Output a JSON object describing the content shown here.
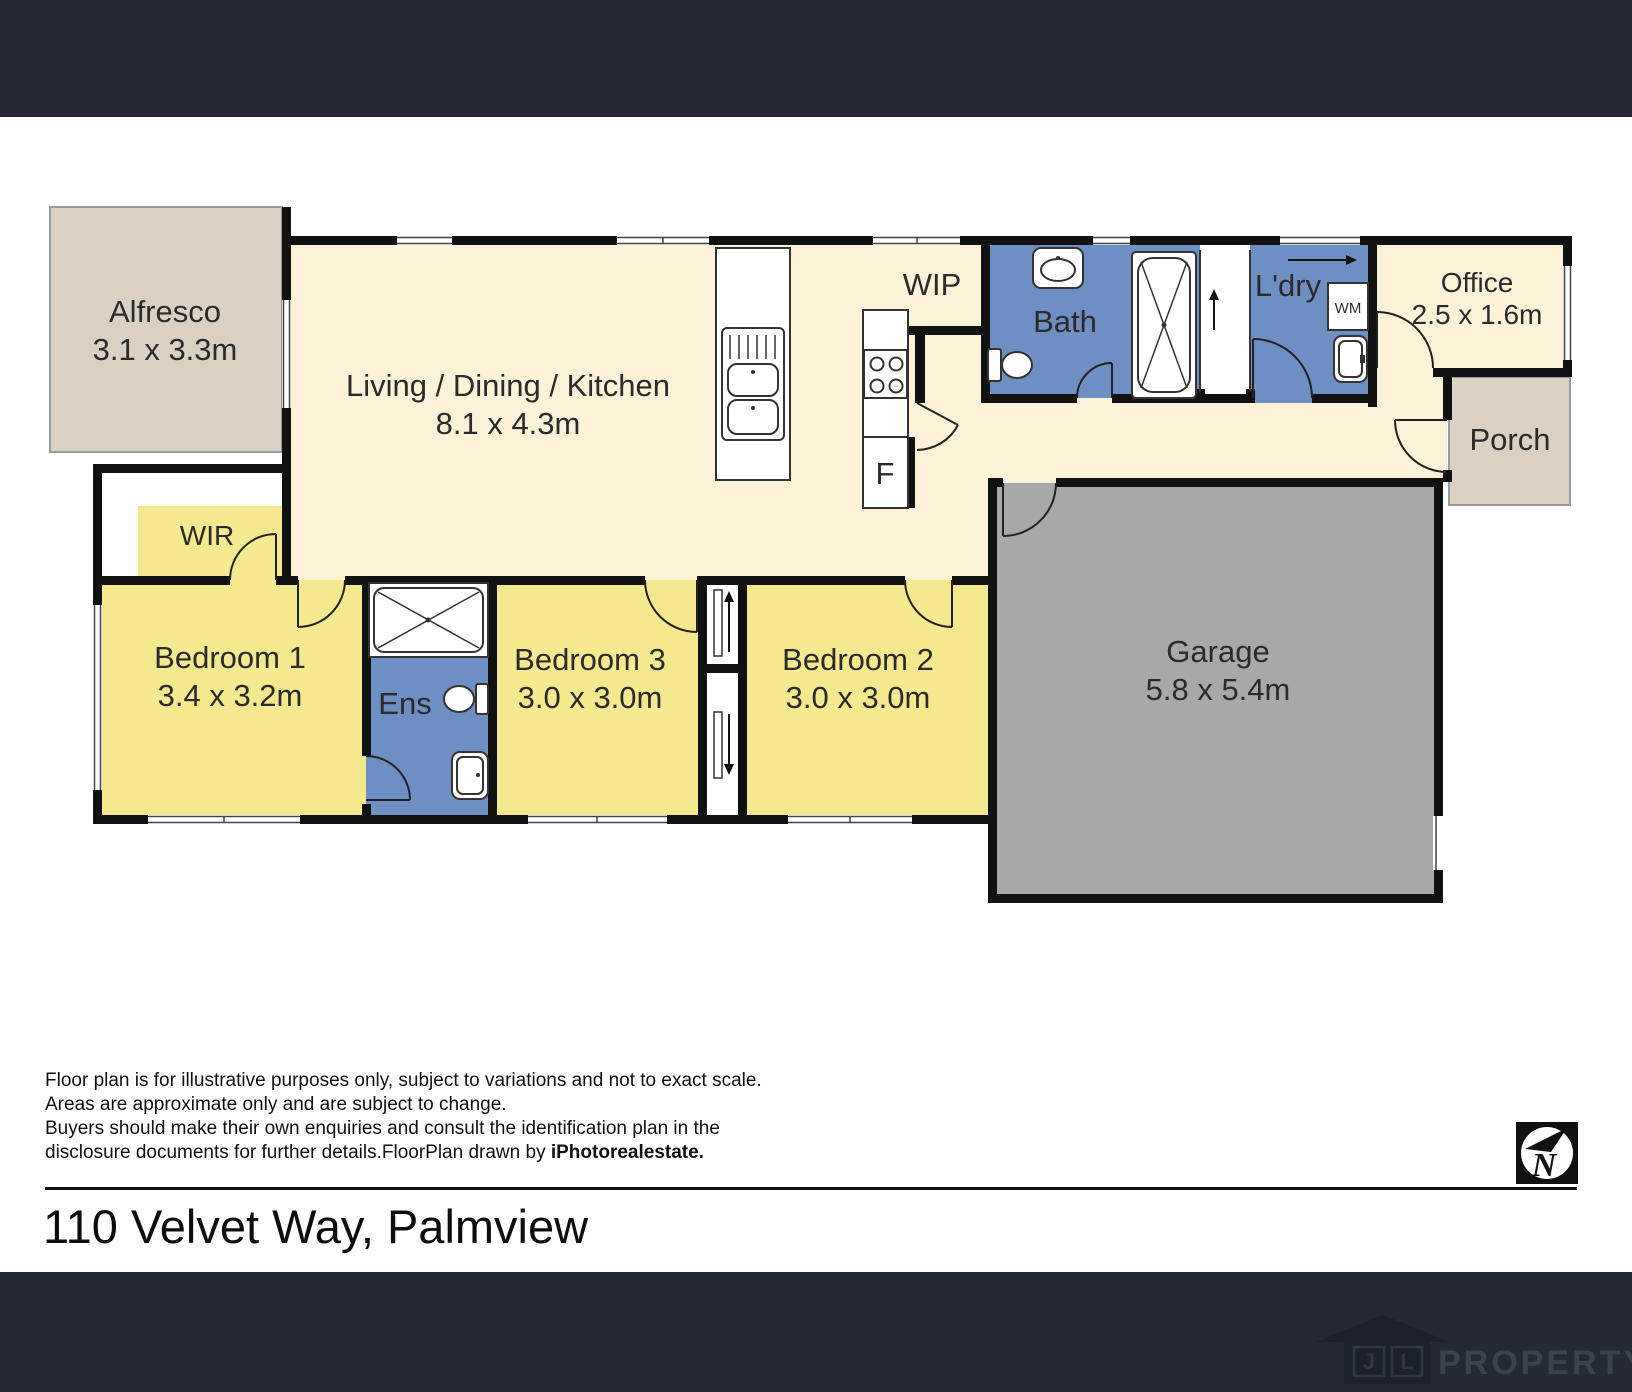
{
  "address": "110 Velvet Way, Palmview",
  "disclaimer": {
    "line1": "Floor plan is for illustrative purposes only, subject to variations and not to exact scale.",
    "line2": "Areas are approximate only and are subject to change.",
    "line3": "Buyers should make their own enquiries and consult the identification plan in the",
    "line4_prefix": "disclosure documents for further details.FloorPlan drawn by ",
    "line4_bold": "iPhotorealestate."
  },
  "compass": {
    "letter": "N"
  },
  "footer_brand": {
    "initial_j": "J",
    "initial_l": "L",
    "name": "PROPERTY"
  },
  "rooms": {
    "alfresco": {
      "name": "Alfresco",
      "dims": "3.1 x 3.3m"
    },
    "living": {
      "name": "Living / Dining / Kitchen",
      "dims": "8.1 x 4.3m"
    },
    "wip": {
      "name": "WIP"
    },
    "bath": {
      "name": "Bath"
    },
    "ldry": {
      "name": "L'dry"
    },
    "office": {
      "name": "Office",
      "dims": "2.5 x 1.6m"
    },
    "porch": {
      "name": "Porch"
    },
    "wir": {
      "name": "WIR"
    },
    "bed1": {
      "name": "Bedroom 1",
      "dims": "3.4 x 3.2m"
    },
    "ens": {
      "name": "Ens"
    },
    "bed3": {
      "name": "Bedroom 3",
      "dims": "3.0 x 3.0m"
    },
    "bed2": {
      "name": "Bedroom 2",
      "dims": "3.0 x 3.0m"
    },
    "garage": {
      "name": "Garage",
      "dims": "5.8 x 5.4m"
    }
  },
  "fixtures": {
    "fridge": "F",
    "washing_machine": "WM"
  },
  "colors": {
    "bar_dark": "#232A34",
    "wall": "#111111",
    "cream": "#FBF2D7",
    "bedroom_yellow": "#F5E98F",
    "wet_blue": "#6D8FC1",
    "garage_gray": "#A8A8A8",
    "outdoor_beige": "#DBD1C3",
    "logo_dark": "#1B222C"
  }
}
